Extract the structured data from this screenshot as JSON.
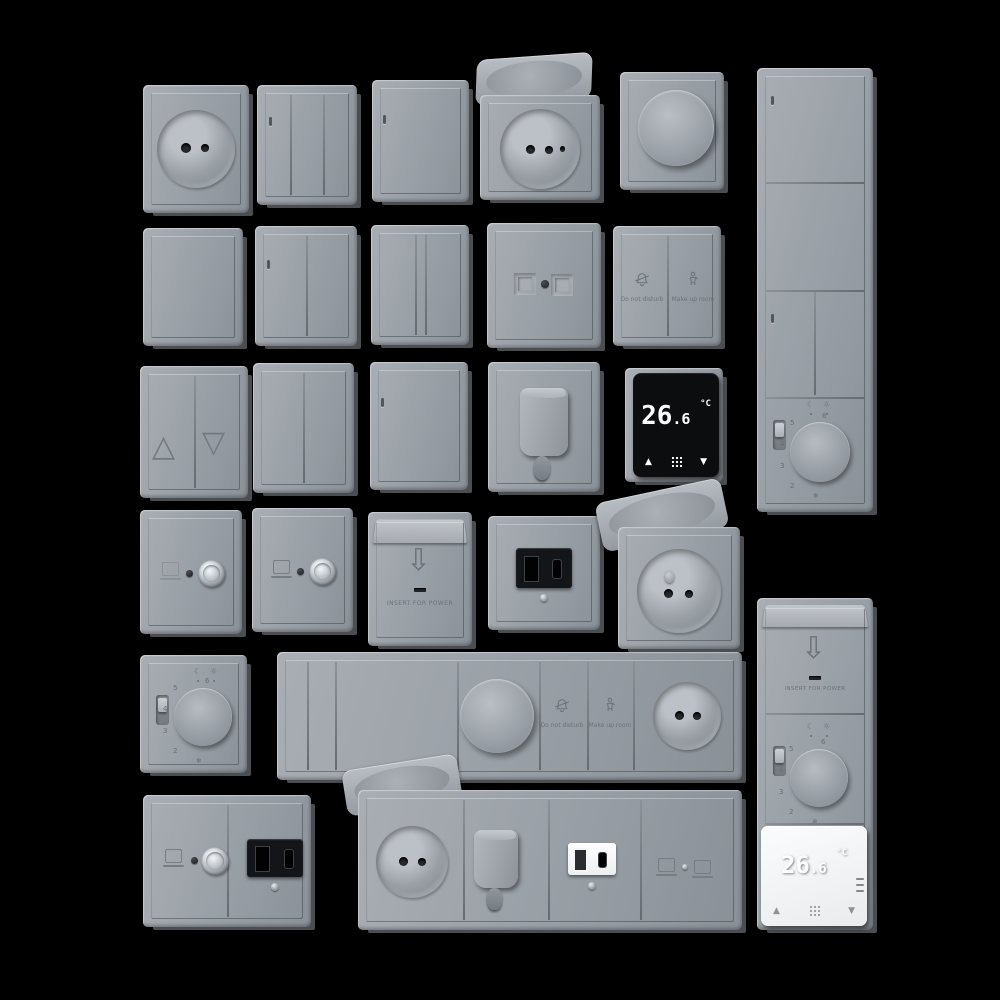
{
  "scene": {
    "description": "3D render: grid of gray electrical wall fittings on black background",
    "colors": {
      "background": "#000000",
      "plate": "#9aa0a7",
      "plate_dark": "#6e747b",
      "plate_light": "#b7bcc2",
      "module_black": "#141518",
      "module_white": "#f4f5f6",
      "display_text": "#ffffff",
      "engraving": "#6d727a"
    }
  },
  "labels": {
    "temp_int": "26",
    "temp_dec": ".6",
    "deg": "°C",
    "insert": "INSERT FOR POWER",
    "dnd": "Do not disturb",
    "mur": "Make up room",
    "up_solid": "▲",
    "down_solid": "▼",
    "up_outline": "△",
    "down_outline": "▽",
    "arrow_down": "⇩",
    "sun": "☼",
    "moon": "☾"
  },
  "dial": {
    "marks": [
      "6",
      "5",
      "4",
      "3",
      "2",
      "❄"
    ]
  },
  "icons": {
    "do-not-disturb-icon": "bell-with-slash",
    "make-up-room-icon": "housekeeper-person",
    "key-card-arrow-icon": "outline-down-arrow",
    "thermostat-menu-icon": "3x3-dot-grid",
    "temp-up-icon": "solid-up-triangle",
    "temp-down-icon": "solid-down-triangle",
    "shutter-up-icon": "outline-up-triangle",
    "shutter-down-icon": "outline-down-triangle",
    "dial-day-icon": "sun",
    "dial-night-icon": "moon",
    "frost-icon": "snowflake",
    "data-outlet-icon": "computer-monitor",
    "sat-connector": "chrome-coax-socket"
  },
  "inventory": {
    "row1": [
      "round-socket",
      "triple-rocker-switch",
      "single-rocker-switch",
      "flip-lid-socket-open",
      "rotary-dimmer"
    ],
    "row2": [
      "blank-plate",
      "double-rocker-switch",
      "double-rocker-switch-slim",
      "dual-data-outlet",
      "hotel-service-switch"
    ],
    "row3": [
      "shutter-switch",
      "double-rocker-switch",
      "single-rocker-switch",
      "cable-outlet-spout",
      "digital-thermostat-black"
    ],
    "row4": [
      "tv-sat-outlet",
      "tv-sat-outlet",
      "key-card-power-holder",
      "usb-charger-black",
      "flip-lid-socket-open"
    ],
    "row5": [
      "analog-thermostat-dial",
      "multi-gang-strip: rockers + dimmer + hotel-buttons + socket"
    ],
    "row6": [
      "tv-sat-usb-combo-plate",
      "multi-gang-strip: lid-socket + cable-spout + usb-white + data-outlet"
    ],
    "right_columns": [
      "tall-switch-panel-with-dial",
      "key-card + dial + digital-thermostat-white"
    ]
  }
}
